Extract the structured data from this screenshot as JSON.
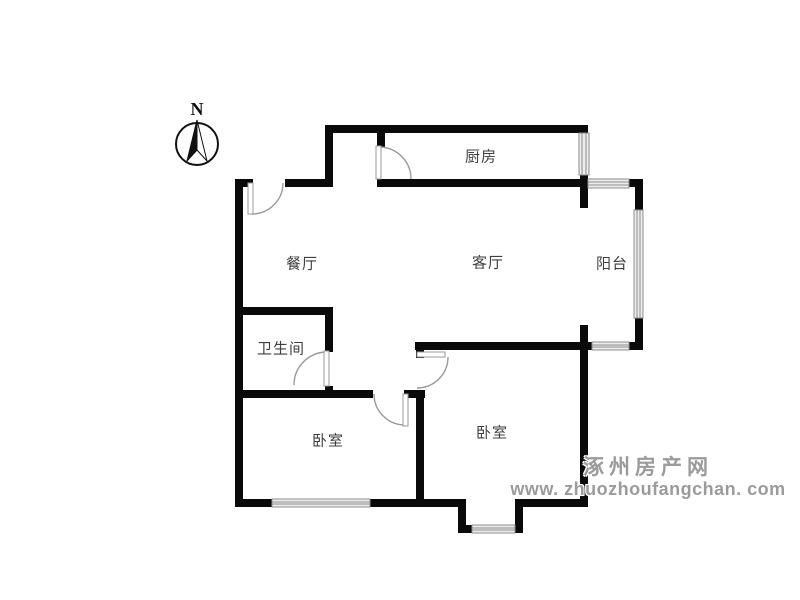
{
  "compass": {
    "north_label": "N"
  },
  "rooms": {
    "kitchen": {
      "label": "厨房"
    },
    "dining": {
      "label": "餐厅"
    },
    "living": {
      "label": "客厅"
    },
    "balcony": {
      "label": "阳台"
    },
    "bathroom": {
      "label": "卫生间"
    },
    "bedroom_left": {
      "label": "卧室"
    },
    "bedroom_right": {
      "label": "卧室"
    }
  },
  "watermark": {
    "site_name": "涿州房产网",
    "site_url": "www. zhuozhoufangchan. com"
  },
  "colors": {
    "wall": "#0a0a0a",
    "label_text": "#3f3f3f",
    "watermark": "#9b9b9b",
    "window_line": "#8e8e8e",
    "door_arc": "#9a9a9a",
    "background": "#ffffff"
  }
}
